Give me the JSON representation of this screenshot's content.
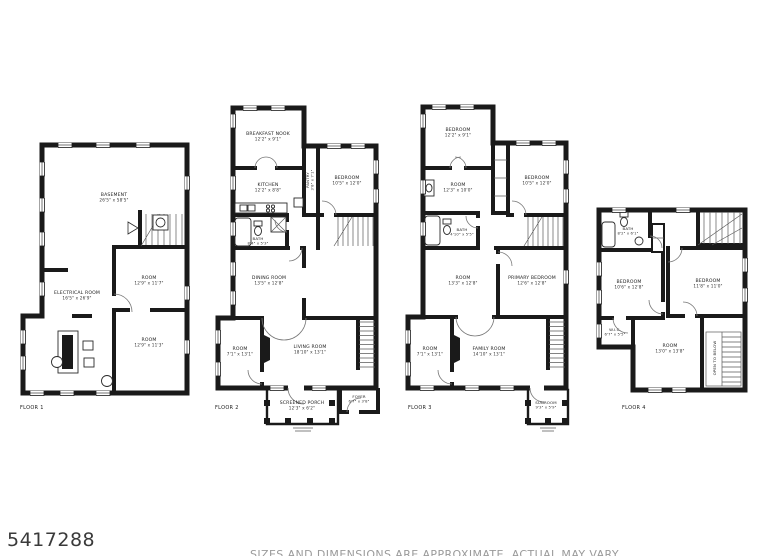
{
  "page": {
    "listing_id": "5417288",
    "disclaimer": "SIZES AND DIMENSIONS ARE APPROXIMATE. ACTUAL MAY VARY.",
    "colors": {
      "walls": "#1a1a1a",
      "labels": "#222222",
      "disclaimer_text": "#9a9a9a",
      "listing_id_text": "#3a3a3a"
    }
  },
  "floors": [
    {
      "label": "FLOOR 1",
      "rooms": [
        {
          "name": "BASEMENT",
          "dims": "26'5\" x 58'5\""
        },
        {
          "name": "ROOM",
          "dims": "12'9\" x 11'7\""
        },
        {
          "name": "ELECTRICAL ROOM",
          "dims": "16'5\" x 26'9\""
        },
        {
          "name": "ROOM",
          "dims": "12'9\" x 11'3\""
        }
      ]
    },
    {
      "label": "FLOOR 2",
      "rooms": [
        {
          "name": "BREAKFAST NOOK",
          "dims": "12'2\" x 9'1\""
        },
        {
          "name": "KITCHEN",
          "dims": "12'2\" x 8'8\""
        },
        {
          "name": "PANTRY",
          "dims": "3'8\" x 7'1\""
        },
        {
          "name": "BEDROOM",
          "dims": "10'5\" x 12'0\""
        },
        {
          "name": "BATH",
          "dims": "8'4\" x 5'3\""
        },
        {
          "name": "DINING ROOM",
          "dims": "13'5\" x 12'8\""
        },
        {
          "name": "ROOM",
          "dims": "7'1\" x 13'1\""
        },
        {
          "name": "LIVING ROOM",
          "dims": "18'10\" x 13'1\""
        },
        {
          "name": "FOYER",
          "dims": "6'7\" x 3'8\""
        },
        {
          "name": "SCREENED PORCH",
          "dims": "12'3\" x 6'2\""
        }
      ]
    },
    {
      "label": "FLOOR 3",
      "rooms": [
        {
          "name": "BEDROOM",
          "dims": "12'2\" x 9'1\""
        },
        {
          "name": "ROOM",
          "dims": "12'3\" x 10'0\""
        },
        {
          "name": "BEDROOM",
          "dims": "10'5\" x 12'0\""
        },
        {
          "name": "BATH",
          "dims": "4'10\" x 5'5\""
        },
        {
          "name": "ROOM",
          "dims": "13'3\" x 12'8\""
        },
        {
          "name": "PRIMARY BEDROOM",
          "dims": "12'6\" x 12'8\""
        },
        {
          "name": "ROOM",
          "dims": "7'1\" x 13'1\""
        },
        {
          "name": "FAMILY ROOM",
          "dims": "14'10\" x 13'1\""
        },
        {
          "name": "SUNROOM",
          "dims": "9'3\" x 5'9\""
        }
      ]
    },
    {
      "label": "FLOOR 4",
      "rooms": [
        {
          "name": "BATH",
          "dims": "8'2\" x 6'1\""
        },
        {
          "name": "BEDROOM",
          "dims": "10'6\" x 12'8\""
        },
        {
          "name": "BEDROOM",
          "dims": "11'8\" x 11'0\""
        },
        {
          "name": "W.I.C.",
          "dims": "6'7\" x 5'5\""
        },
        {
          "name": "ROOM",
          "dims": "13'0\" x 13'8\""
        }
      ],
      "annotations": [
        "OPEN TO BELOW"
      ]
    }
  ]
}
